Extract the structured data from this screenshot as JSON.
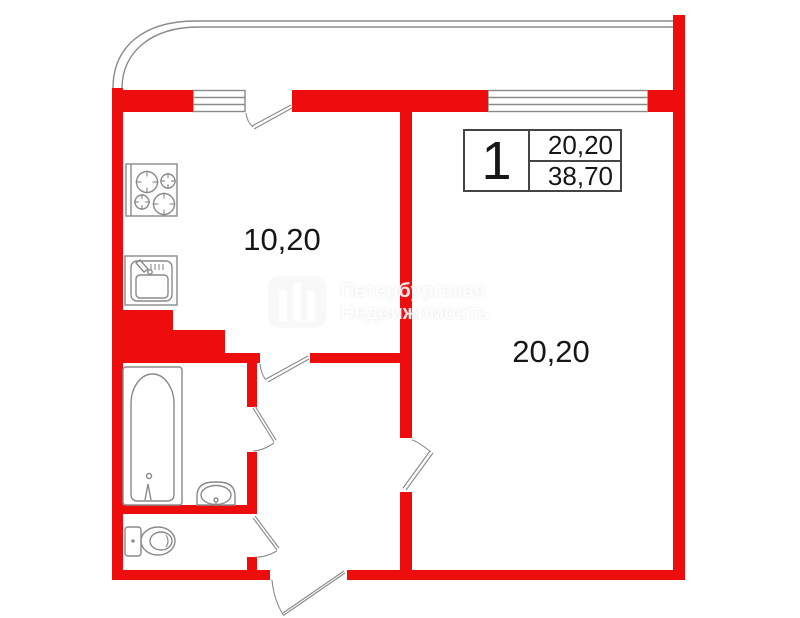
{
  "colors": {
    "wall": "#ee0d0d",
    "outline": "#8a8a8a",
    "info_border": "#454545",
    "text": "#161616"
  },
  "info_box": {
    "apartment_number": "1",
    "living_area": "20,20",
    "total_area": "38,70"
  },
  "room_labels": {
    "kitchen": "10,20",
    "living_room": "20,20"
  },
  "watermark": {
    "line1": "Петербургская",
    "line2": "Недвижимость"
  },
  "fixtures": [
    "stove",
    "kitchen-sink",
    "bathtub",
    "wash-basin",
    "toilet"
  ]
}
